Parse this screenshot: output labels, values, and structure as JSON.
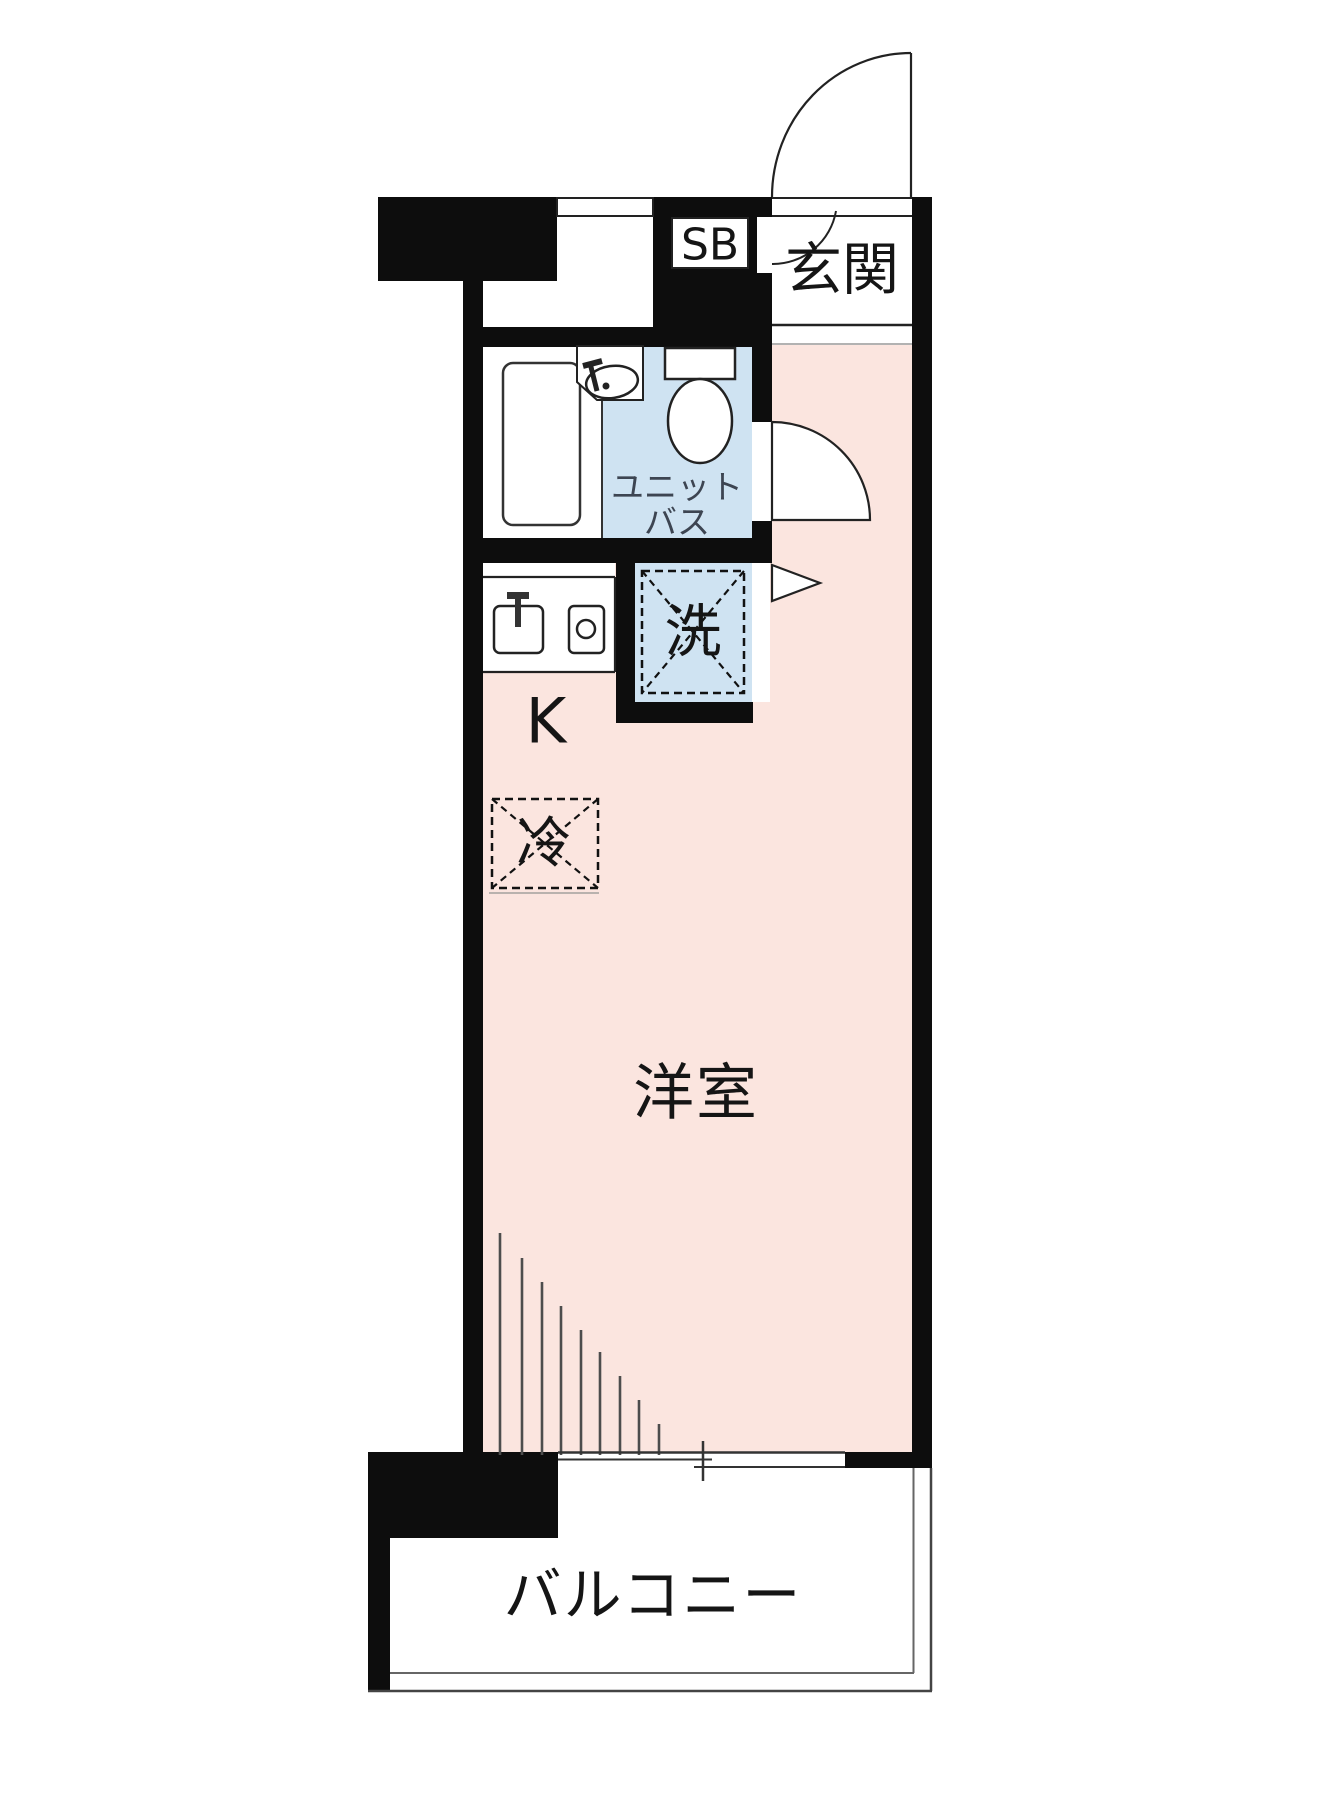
{
  "plan": {
    "title": "studio-apartment-floor-plan",
    "labels": {
      "entrance": "玄関",
      "shoe_box": "SB",
      "unit_bath_line1": "ユニット",
      "unit_bath_line2": "バス",
      "washing_machine": "洗",
      "kitchen": "K",
      "refrigerator": "冷",
      "western_room": "洋室",
      "balcony": "バルコニー"
    },
    "colors": {
      "room_pink": "#fbe5df",
      "bath_blue": "#cfe3f2",
      "wall_black": "#0d0d0d",
      "label_text": "#151515",
      "unit_bath_text": "#3d4552",
      "thin_line": "#222222",
      "rail_gray": "#555555"
    }
  }
}
